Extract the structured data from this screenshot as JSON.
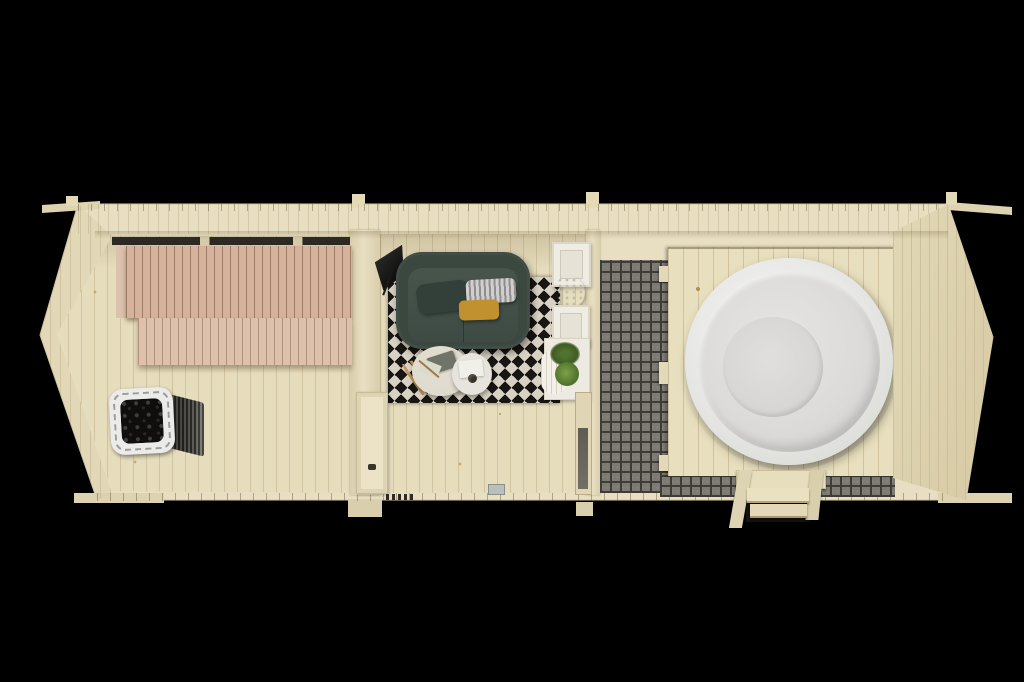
{
  "scene": {
    "subject": "top-down 3D render of a long wooden sauna cabin",
    "view": "bird's-eye floor plan",
    "rooms": [
      {
        "name": "sauna room",
        "contents": [
          "two-tier slatted bench",
          "sauna heater with stones"
        ]
      },
      {
        "name": "lounge room",
        "contents": [
          "green sofa with three pillows",
          "geometric black-white rug",
          "two round coffee tables",
          "floor lamp",
          "white wall shelves with coral decor",
          "plant table with two plants"
        ]
      },
      {
        "name": "terrace",
        "contents": [
          "gray mosaic tile floor",
          "wooden deck platform",
          "round white hot tub",
          "wooden entry steps"
        ]
      }
    ]
  },
  "palette": {
    "bg": "#000000",
    "wall": "#e8dfc2",
    "wallShade": "#d9cead",
    "wallEdge": "#cfc39d",
    "beam": "#ddd3b1",
    "tab": "#e4dab8",
    "floor": "#e6ddbd",
    "bench1": "#d4b29b",
    "bench2": "#ddc1ac",
    "slitDark": "#2c2822",
    "stoveRim": "#ebebe9",
    "stones": "#0f0e0c",
    "sofa": "#3b4840",
    "sofaSeat": "#47554d",
    "pillowGreen": "#33403a",
    "mustard": "#c2912f",
    "rugDark": "#181512",
    "rugLight": "#d8d2c4",
    "tableCream": "#ded9cc",
    "tableWhite": "#e7e4de",
    "shelfWhite": "#efece4",
    "plantGreen": "#4d7028",
    "lampBlack": "#1b1b19",
    "tile": "#7d7a73",
    "grout": "#3e3c36",
    "deck": "#e8dfbe",
    "tub": "#eaeae8",
    "tubMid": "#dbdad8",
    "tubInner": "#d5d4d2",
    "glass": "#5e5c55",
    "doorPanel": "#ece3c6",
    "vent": "#b9bfbd"
  }
}
